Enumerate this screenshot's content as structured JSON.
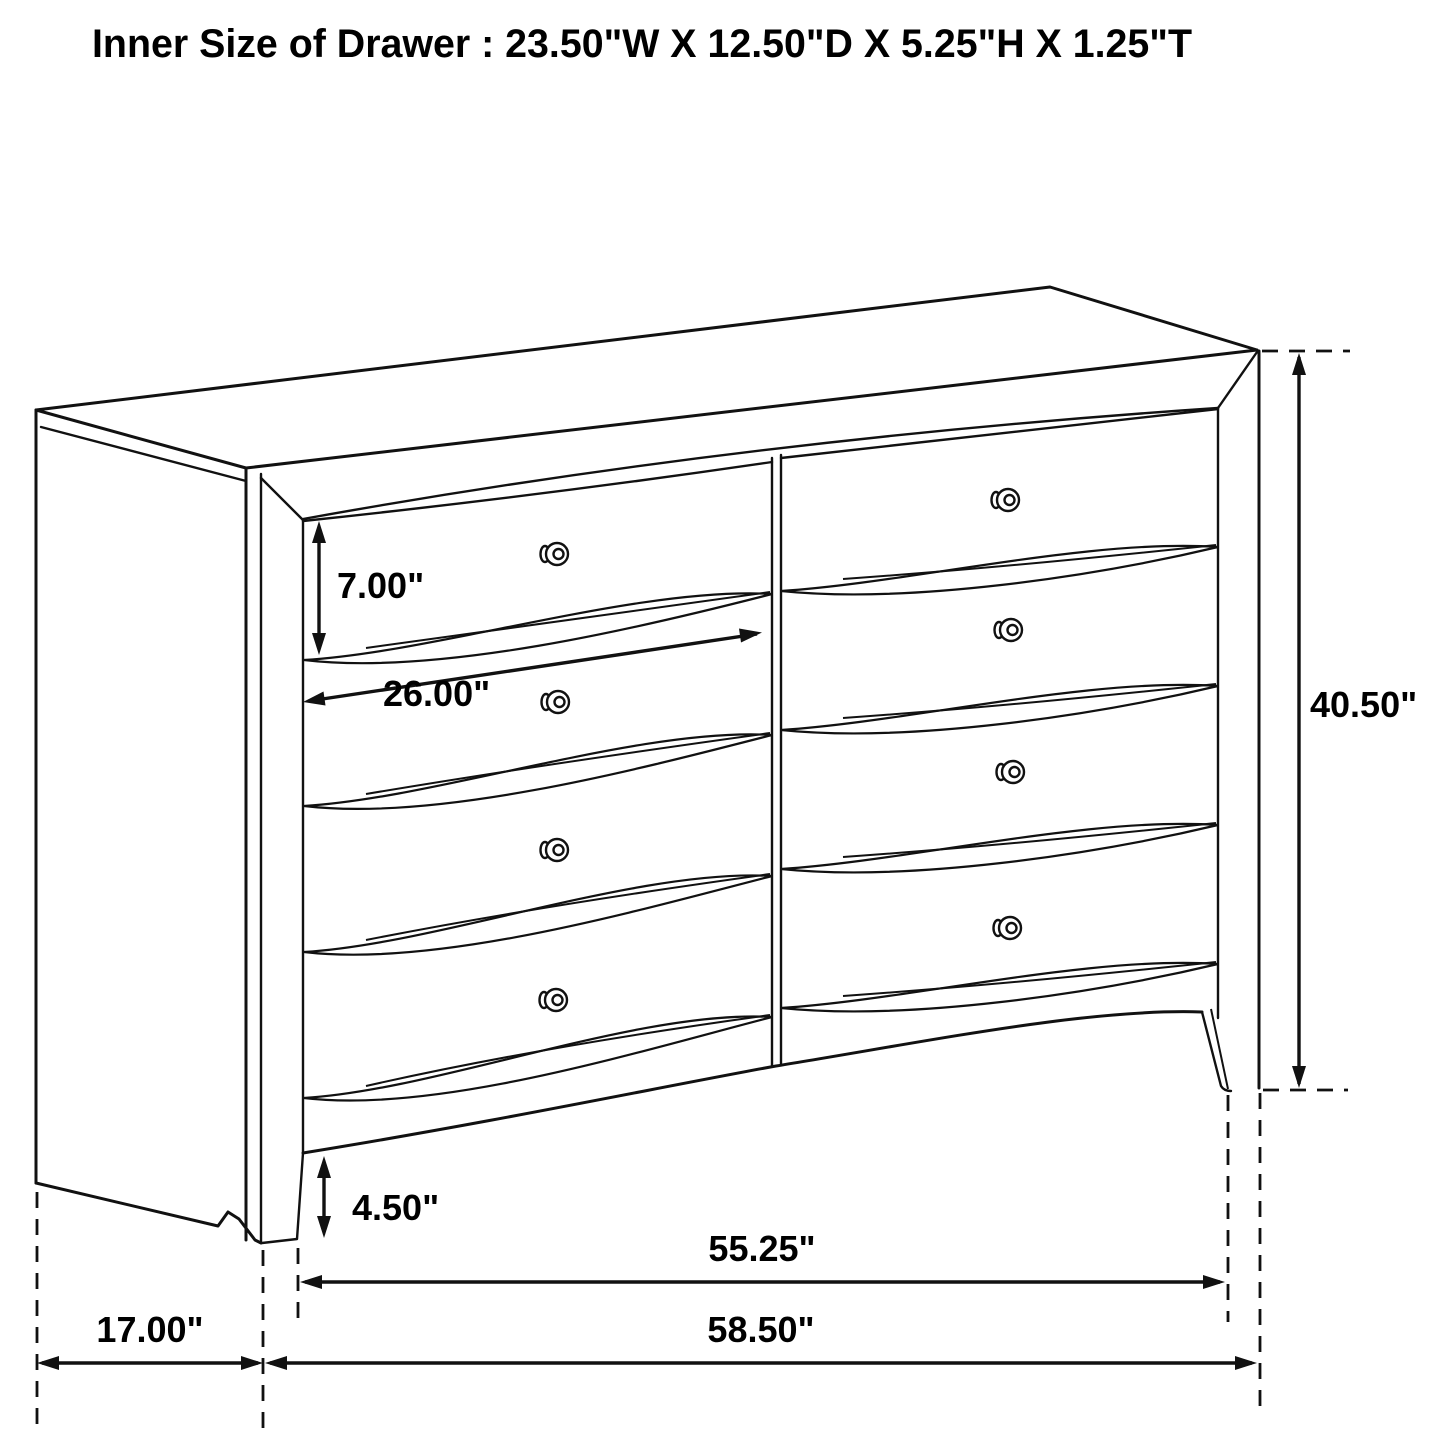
{
  "page": {
    "background": "#ffffff",
    "line_color": "#111111"
  },
  "title": "Inner Size of Drawer : 23.50\"W X 12.50\"D X 5.25\"H X 1.25\"T",
  "inner_drawer_size": {
    "width": "23.50\"",
    "depth": "12.50\"",
    "height": "5.25\"",
    "thickness": "1.25\""
  },
  "dimensions": {
    "drawer_front_height": "7.00\"",
    "drawer_width": "26.00\"",
    "overall_height": "40.50\"",
    "base_height": "4.50\"",
    "width_between_legs": "55.25\"",
    "overall_width": "58.50\"",
    "overall_depth": "17.00\""
  },
  "drawing": {
    "type": "furniture-dimension-diagram",
    "item": "6-drawer dresser",
    "columns": 2,
    "drawers_per_column": 4,
    "knob_count": 8
  }
}
